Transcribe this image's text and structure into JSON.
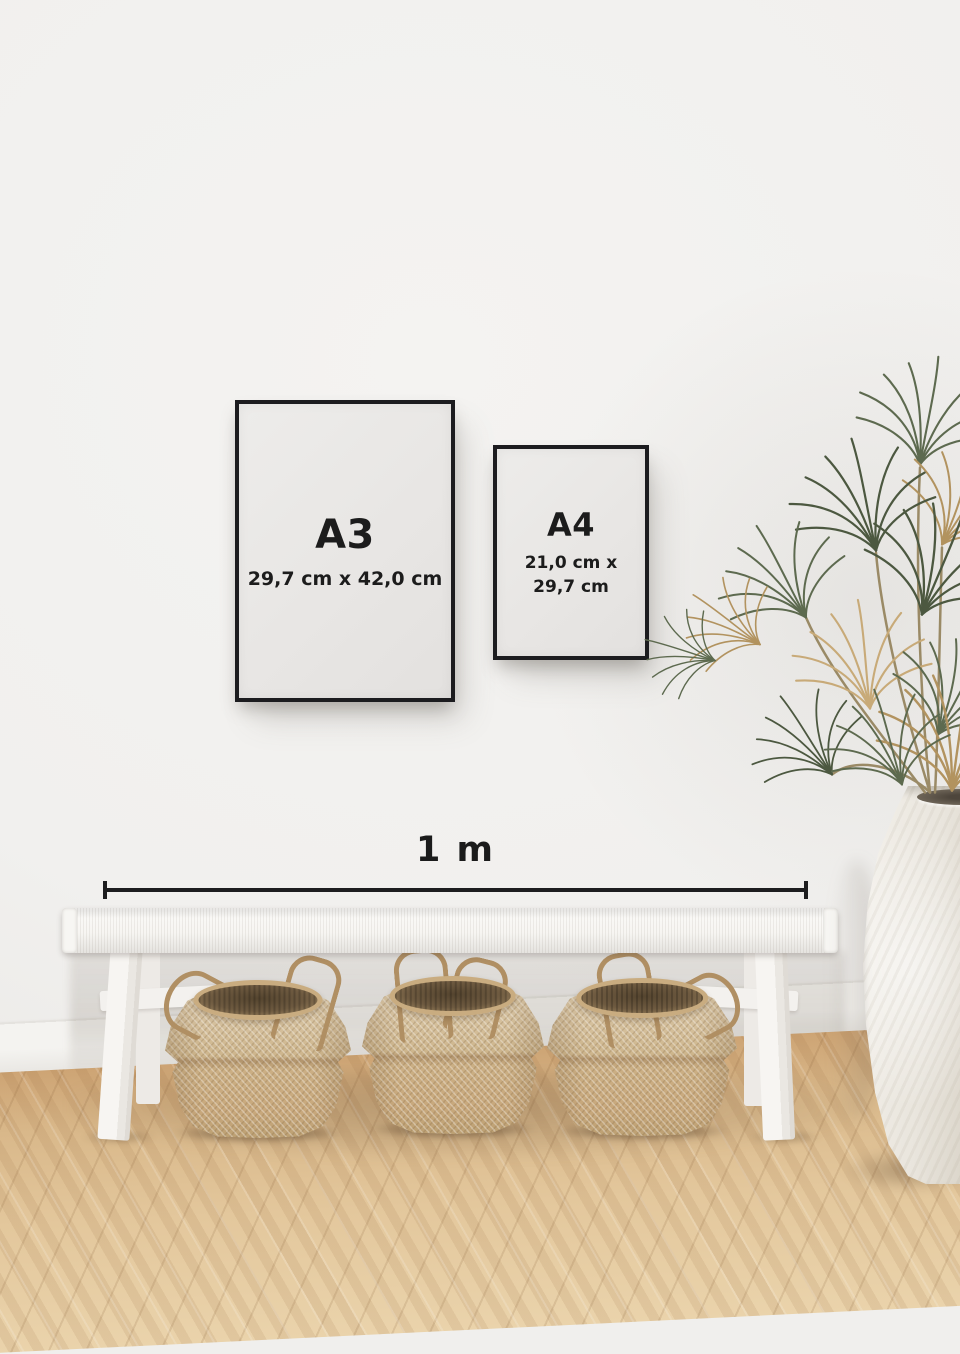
{
  "scene": {
    "description": "Interior wall mockup comparing poster frame sizes above a bench with baskets, a palm plant and a vase",
    "frames": [
      {
        "label": "A3",
        "dimensions": "29,7 cm x 42,0 cm"
      },
      {
        "label": "A4",
        "dimensions_lines": [
          "21,0 cm x",
          "29,7 cm"
        ]
      }
    ],
    "scale_bar": {
      "label": "1 m"
    },
    "colors": {
      "wall": "#f0efed",
      "frame_border": "#1c1c1f",
      "frame_paper": "#e9e8e6",
      "text": "#1c1c1c",
      "bench": "#f7f6f3",
      "basket": "#cdb086",
      "floor_wood": "#d9ba8c",
      "plant_green": "#5d6a4f",
      "plant_dried": "#b2935f",
      "vase": "#ece8e0"
    }
  }
}
